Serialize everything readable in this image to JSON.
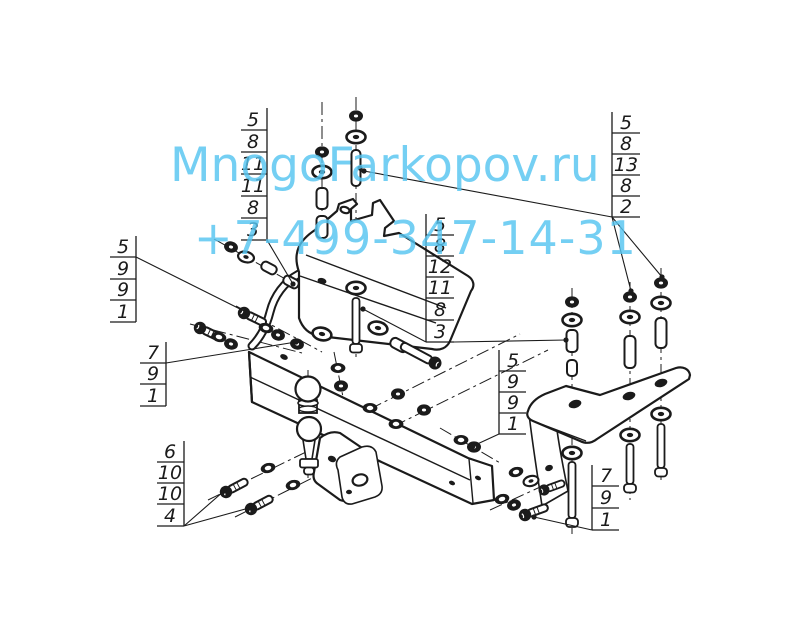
{
  "watermark": {
    "site": "MnogoFarkopov.ru",
    "phone": "+7-499-347-14-31",
    "color": "#56c4f0"
  },
  "drawing": {
    "type": "exploded-assembly-diagram",
    "subject": "tow-hitch (фаркоп) crossbar with ball mount, side plates and fasteners",
    "line_color": "#1b1b1b",
    "background": "#ffffff",
    "icons": [
      "tow-ball-icon",
      "bolt-icon",
      "nut-icon",
      "washer-icon",
      "sleeve-icon",
      "bracket-icon"
    ]
  },
  "callouts": [
    {
      "id": "top-left",
      "values": [
        "5",
        "8",
        "11",
        "11",
        "8",
        "3"
      ]
    },
    {
      "id": "top-right",
      "values": [
        "5",
        "8",
        "13",
        "8",
        "2"
      ]
    },
    {
      "id": "center",
      "values": [
        "5",
        "8",
        "12",
        "11",
        "8",
        "3"
      ]
    },
    {
      "id": "left-upper",
      "values": [
        "5",
        "9",
        "9",
        "1"
      ]
    },
    {
      "id": "left-lower",
      "values": [
        "7",
        "9",
        "1"
      ]
    },
    {
      "id": "bottom-left",
      "values": [
        "6",
        "10",
        "10",
        "4"
      ]
    },
    {
      "id": "right",
      "values": [
        "5",
        "9",
        "9",
        "1"
      ]
    },
    {
      "id": "bottom-right",
      "values": [
        "7",
        "9",
        "1"
      ]
    }
  ]
}
